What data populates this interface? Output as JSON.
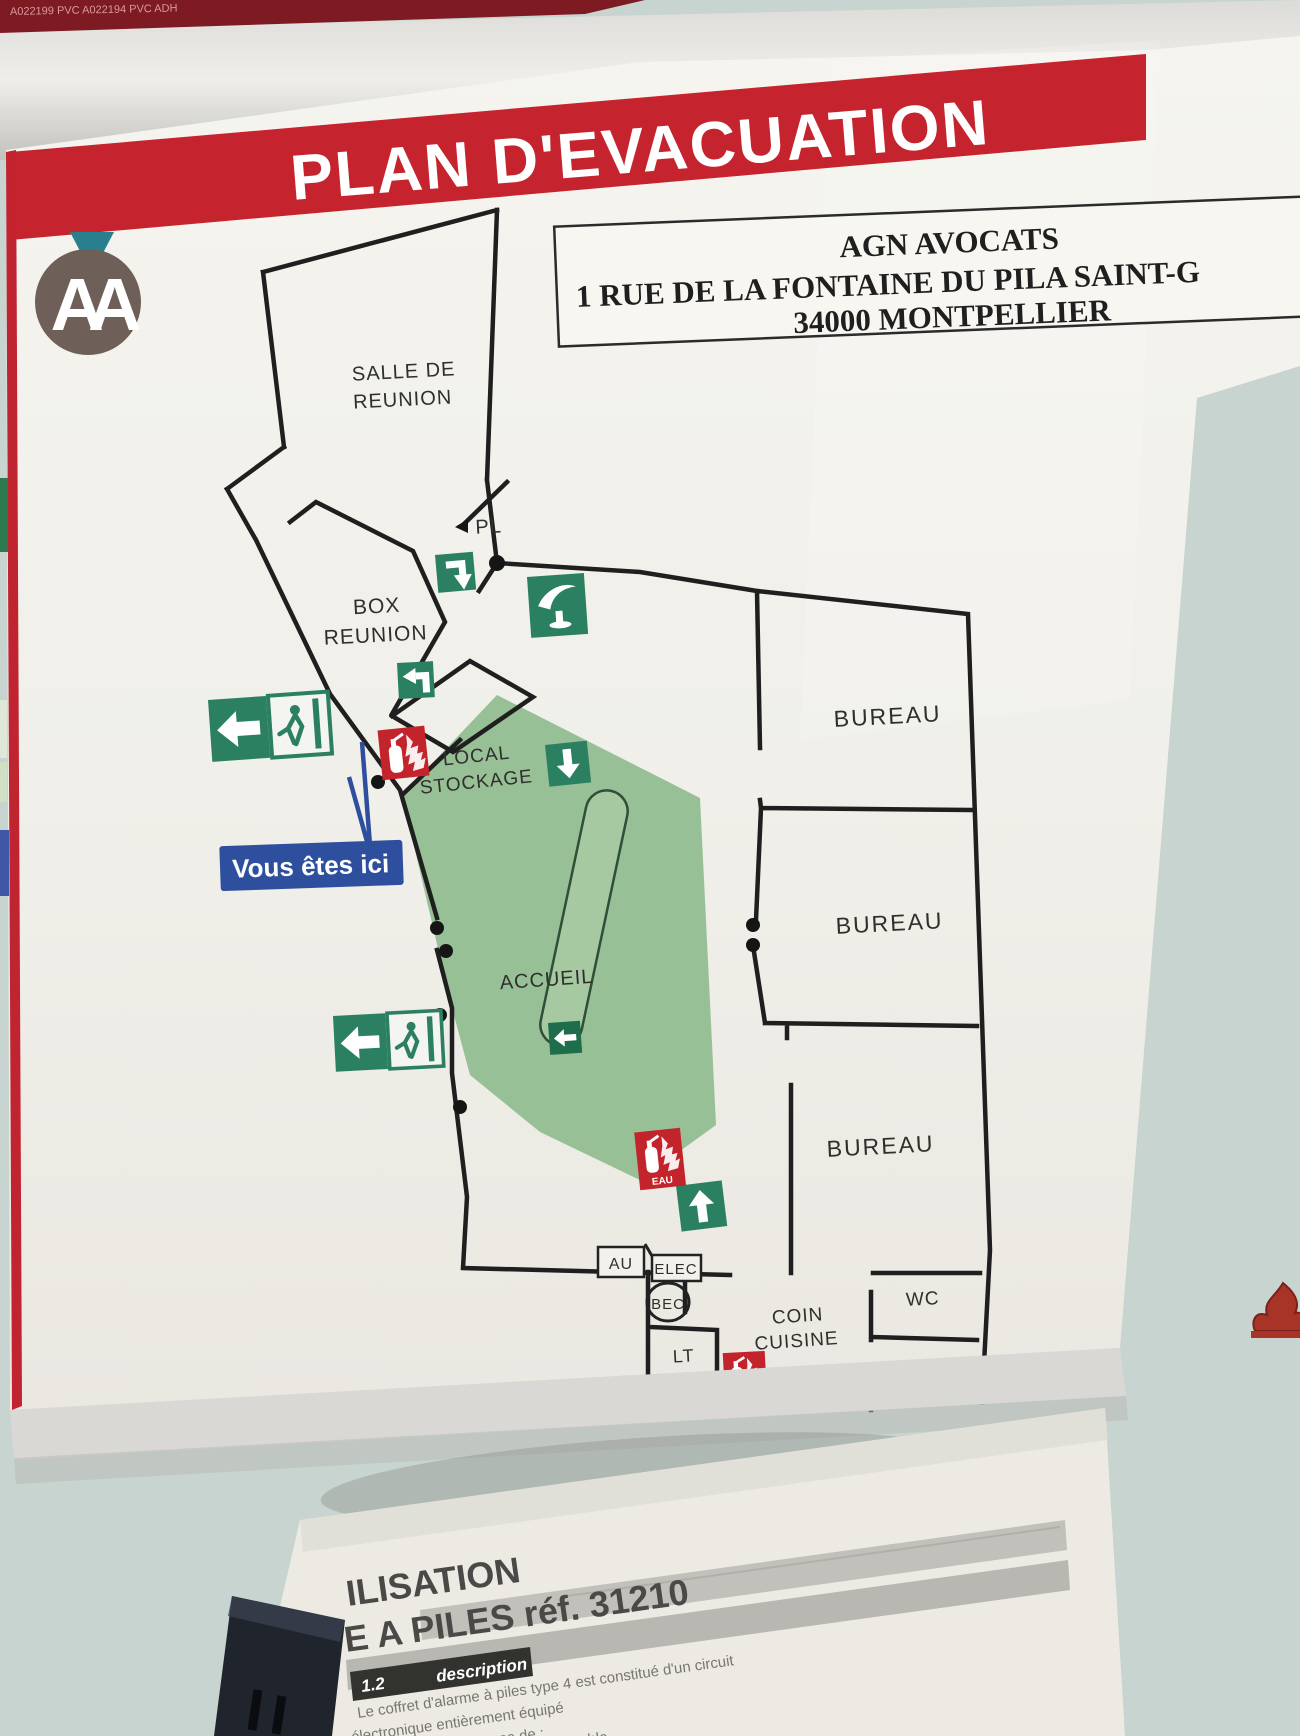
{
  "top_strip": {
    "code": "A022199 PVC   A022194 PVC ADH"
  },
  "banner": {
    "title": "PLAN D'EVACUATION",
    "bg": "#c5232d"
  },
  "logo": {
    "letters": "AA"
  },
  "address_box": {
    "line1": "AGN AVOCATS",
    "line2": "1 RUE DE LA FONTAINE DU PILA SAINT-G",
    "line3": "34000 MONTPELLIER"
  },
  "you_are_here": {
    "label": "Vous êtes ici"
  },
  "rooms": {
    "salle1": "SALLE DE",
    "salle2": "REUNION",
    "pl": "PL",
    "box1": "BOX",
    "box2": "REUNION",
    "local1": "LOCAL",
    "local2": "STOCKAGE",
    "accueil": "ACCUEIL",
    "bureau_top": "BUREAU",
    "bureau_mid": "BUREAU",
    "bureau_bottom": "BUREAU",
    "wc_top": "WC",
    "wc_bottom": "WC",
    "coin1": "COIN",
    "coin2": "CUISINE",
    "lt1": "LT",
    "lt2": "EDF",
    "bec": "BEC",
    "au": "AU",
    "elec": "ELEC"
  },
  "extinguisher_labels": {
    "eau": "EAU",
    "co2": "CO2"
  },
  "colors": {
    "banner_red": "#c5232d",
    "safety_green": "#2c8062",
    "zone_green": "#98c096",
    "alarm_red": "#c3242b",
    "here_blue": "#2e4f9e",
    "wall_cyan": "#c7d4d0",
    "logo_brown": "#6e6058",
    "logo_teal": "#2a7f8f"
  },
  "paper": {
    "title1": "ILISATION",
    "title2": "E A PILES réf. 31210",
    "sec_num": "1.2",
    "sec_label": "description",
    "body_line1": "Le coffret d'alarme à piles type 4 est constitué d'un circuit",
    "body_line2": "électronique entièrement équipé",
    "body_line3": "L'ensemble se compose de :",
    "body_line4": "déformable"
  }
}
